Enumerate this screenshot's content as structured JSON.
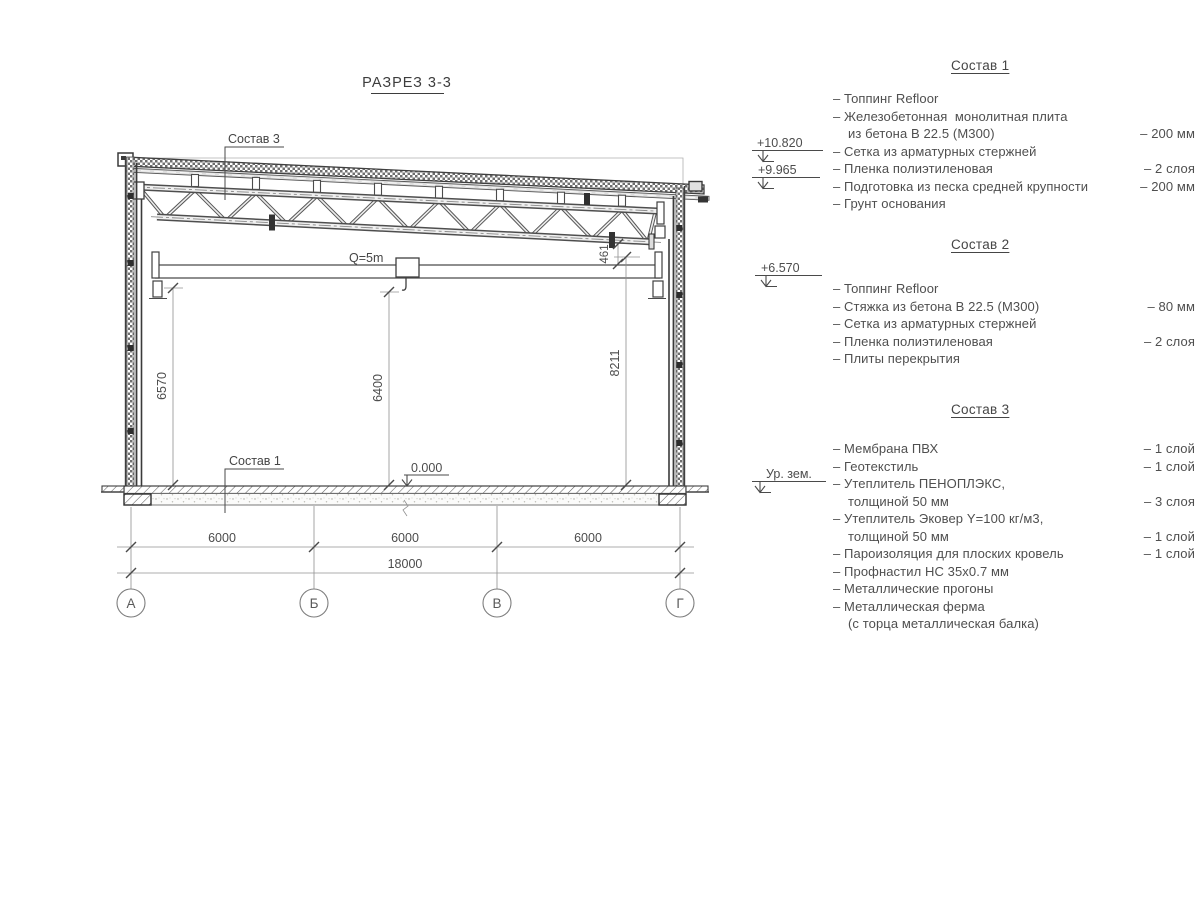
{
  "colors": {
    "ink": "#4a4a4a",
    "paper": "#ffffff"
  },
  "title": {
    "text": "РАЗРЕЗ 3-3"
  },
  "drawing": {
    "labels": {
      "sostav3": "Состав 3",
      "sostav1": "Состав 1",
      "crane_capacity": "Q=5m",
      "zero_level": "0.000"
    },
    "elevations": {
      "roof_high": "+10.820",
      "roof_low": "+9.965",
      "crane_rail": "+6.570",
      "ground": "Ур. зем."
    },
    "dims": {
      "clear_height_left": "6570",
      "hook_height": "6400",
      "truss_bottom_height": "8211",
      "truss_to_rail": "461",
      "span1": "6000",
      "span2": "6000",
      "span3": "6000",
      "total": "18000"
    },
    "axes": {
      "a": "А",
      "b": "Б",
      "v": "В",
      "g": "Г"
    }
  },
  "specs": [
    {
      "heading": "Состав 1",
      "items": [
        {
          "text": "– Топпинг Refloor",
          "value": ""
        },
        {
          "text": "– Железобетонная  монолитная плита",
          "value": ""
        },
        {
          "text": "из бетона В 22.5 (М300)",
          "value": "– 200 мм",
          "indent": true
        },
        {
          "text": "– Сетка из арматурных стержней",
          "value": ""
        },
        {
          "text": "– Пленка полиэтиленовая",
          "value": "– 2 слоя"
        },
        {
          "text": "– Подготовка из песка средней крупности",
          "value": "– 200 мм"
        },
        {
          "text": "– Грунт основания",
          "value": ""
        }
      ]
    },
    {
      "heading": "Состав 2",
      "items": [
        {
          "text": "– Топпинг Refloor",
          "value": ""
        },
        {
          "text": "– Стяжка из бетона В 22.5 (М300)",
          "value": "– 80 мм"
        },
        {
          "text": "– Сетка из арматурных стержней",
          "value": ""
        },
        {
          "text": "– Пленка полиэтиленовая",
          "value": "– 2 слоя"
        },
        {
          "text": "– Плиты перекрытия",
          "value": ""
        }
      ]
    },
    {
      "heading": "Состав 3",
      "items": [
        {
          "text": "– Мембрана ПВХ",
          "value": "– 1 слой"
        },
        {
          "text": "– Геотекстиль",
          "value": "– 1 слой"
        },
        {
          "text": "– Утеплитель ПЕНОПЛЭКС,",
          "value": ""
        },
        {
          "text": "толщиной 50 мм",
          "value": "– 3 слоя",
          "indent": true
        },
        {
          "text": "– Утеплитель Эковер Y=100 кг/м3,",
          "value": ""
        },
        {
          "text": "толщиной 50 мм",
          "value": "– 1 слой",
          "indent": true
        },
        {
          "text": "– Пароизоляция для плоских кровель",
          "value": "– 1 слой"
        },
        {
          "text": "– Профнастил НС 35х0.7 мм",
          "value": ""
        },
        {
          "text": "– Металлические прогоны",
          "value": ""
        },
        {
          "text": "– Металлическая ферма",
          "value": ""
        },
        {
          "text": "(с торца металлическая балка)",
          "value": "",
          "indent": true
        }
      ]
    }
  ]
}
